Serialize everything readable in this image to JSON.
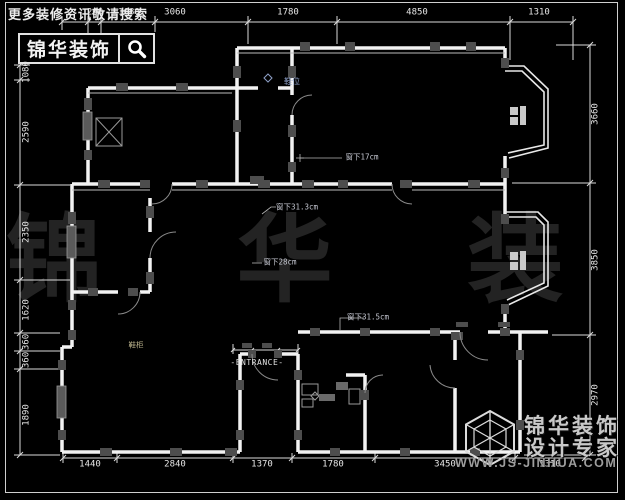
{
  "colors": {
    "background": "#000000",
    "wall": "#f2f2f2",
    "dimension_text": "#e6e6e6",
    "watermark": "#232323",
    "annotation_blue": "#8ea0c8",
    "gray_block": "#4d4d4d"
  },
  "header": {
    "tagline": "更多装修资讯敬请搜索",
    "logo_text": "锦华装饰",
    "search_icon": "magnifier"
  },
  "watermark": "锦 华 装 饰",
  "footer": {
    "cube_icon": "hex-cube-logo",
    "brand_line1": "锦华装饰",
    "brand_line2": "设计专家",
    "website": "WWW.JS-JINHUA.COM"
  },
  "dimensions": {
    "top": [
      "260",
      "1080",
      "3060",
      "1780",
      "4850",
      "1310"
    ],
    "bottom": [
      "1440",
      "2840",
      "1370",
      "1780",
      "3450",
      "1310"
    ],
    "left": [
      "1080",
      "2590",
      "2350",
      "1620",
      "360",
      "360",
      "1890"
    ],
    "right": [
      "3660",
      "3850",
      "2970"
    ]
  },
  "annotations": {
    "shoe_position": "鞋位",
    "window_note_1": "窗下17cm",
    "window_note_2": "窗下31.3cm",
    "window_note_3": "窗下28cm",
    "window_note_4": "窗下31.5cm",
    "entrance": "-ENTRANCE-",
    "shoe_cabinet": "鞋柜"
  }
}
